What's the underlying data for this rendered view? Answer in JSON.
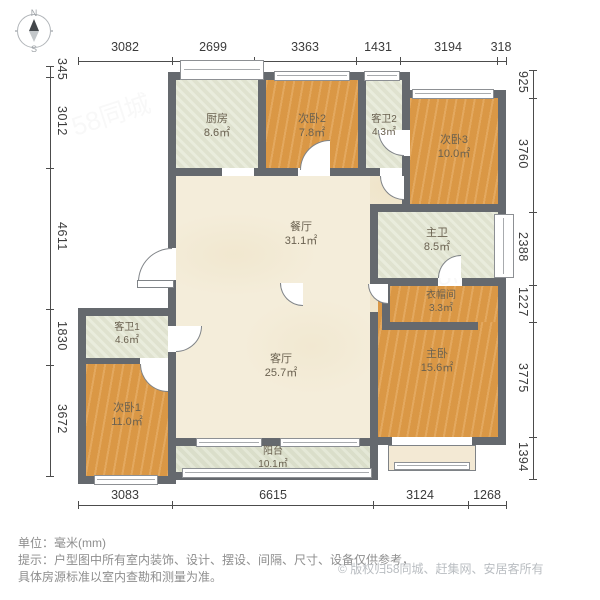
{
  "compass": {
    "north": "N",
    "south": "S"
  },
  "dimensions": {
    "top": [
      "3082",
      "2699",
      "3363",
      "1431",
      "3194",
      "318"
    ],
    "bottom": [
      "3083",
      "6615",
      "3124",
      "1268"
    ],
    "left": [
      "345",
      "3012",
      "4611",
      "1830",
      "3672"
    ],
    "right": [
      "925",
      "3760",
      "2388",
      "1227",
      "3775",
      "1394"
    ]
  },
  "rooms": [
    {
      "name": "厨房",
      "area": "8.6㎡"
    },
    {
      "name": "次卧2",
      "area": "7.8㎡"
    },
    {
      "name": "客卫2",
      "area": "4.3㎡"
    },
    {
      "name": "次卧3",
      "area": "10.0㎡"
    },
    {
      "name": "餐厅",
      "area": "31.1㎡"
    },
    {
      "name": "主卫",
      "area": "8.5㎡"
    },
    {
      "name": "衣帽间",
      "area": "3.3㎡"
    },
    {
      "name": "客卫1",
      "area": "4.6㎡"
    },
    {
      "name": "客厅",
      "area": "25.7㎡"
    },
    {
      "name": "主卧",
      "area": "15.6㎡"
    },
    {
      "name": "次卧1",
      "area": "11.0㎡"
    },
    {
      "name": "阳台",
      "area": "10.1㎡"
    }
  ],
  "footer": {
    "unit": "单位：毫米(mm)",
    "tip_line1": "提示：户型图中所有室内装饰、设计、摆设、间隔、尺寸、设备仅供参考，",
    "tip_line2": "具体房源标准以室内查勘和测量为准。",
    "copyright_symbol": "©",
    "copyright": "版权归58同城、赶集网、安居客所有"
  },
  "colors": {
    "wall": "#65696e",
    "wood": "#df9b47",
    "tile": "#e2e5d1",
    "floor": "#f4edda",
    "balcony": "#dde1cc"
  },
  "watermark": "58同城"
}
